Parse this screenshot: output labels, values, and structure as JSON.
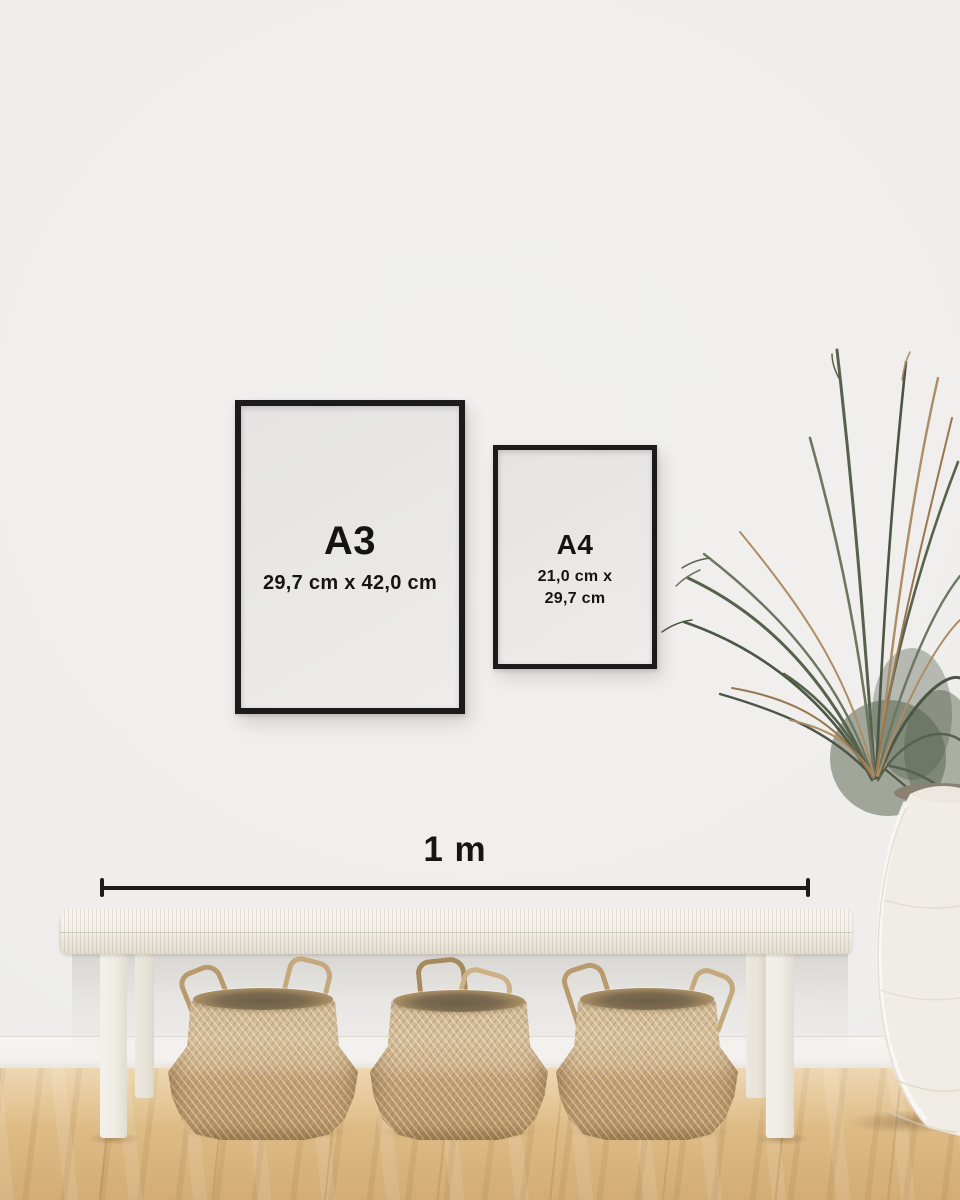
{
  "size_guide": {
    "frames": [
      {
        "label": "A3",
        "size_lines": [
          "29,7 cm x 42,0 cm"
        ]
      },
      {
        "label": "A4",
        "size_lines": [
          "21,0 cm x",
          "29,7 cm"
        ]
      }
    ],
    "ruler": {
      "label": "1 m"
    }
  },
  "palette": {
    "wall": "#efeeec",
    "frame": "#1b1b1d",
    "paper": "#e9e8e6",
    "text": "#141414",
    "floor_light": "#e7c795",
    "floor_dark": "#d3ac75",
    "bench_white": "#f2efe9",
    "basket_light": "#d7bf9a",
    "basket_dark": "#bb9868",
    "leaf_green": "#57624c",
    "leaf_dry": "#ad8d65",
    "vase_white": "#f0ede6"
  },
  "decor": {
    "plant": "dried-palm-plant",
    "vase": "white-stone-urn",
    "bench": "white-woven-bench",
    "baskets": [
      "seagrass-belly-basket",
      "seagrass-belly-basket",
      "seagrass-belly-basket"
    ]
  }
}
